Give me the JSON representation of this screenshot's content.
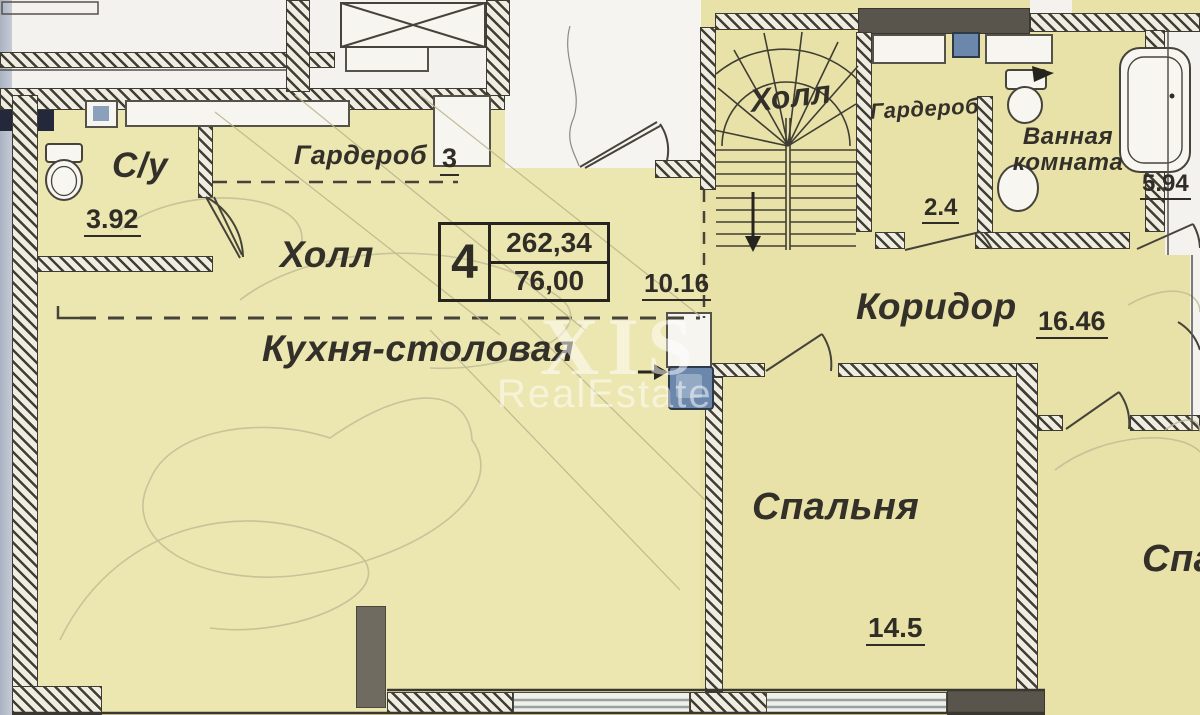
{
  "plan": {
    "unit_info": {
      "rooms_count": "4",
      "total_area": "262,34",
      "living_area": "76,00"
    },
    "rooms": {
      "su": {
        "name": "С/у",
        "area": "3.92"
      },
      "wardrobe_hall": {
        "name": "Гардероб",
        "area": "3"
      },
      "hall": {
        "name": "Холл",
        "area": "10.16"
      },
      "kitchen_dining": {
        "name": "Кухня-столовая"
      },
      "stair_hall": {
        "name": "Холл"
      },
      "wardrobe_2": {
        "name": "Гардероб",
        "area": "2.4"
      },
      "bathroom": {
        "name": "Ванная комната",
        "area": "5.94"
      },
      "corridor": {
        "name": "Коридор",
        "area": "16.46"
      },
      "bedroom_1": {
        "name": "Спальня",
        "area": "14.5"
      },
      "bedroom_2": {
        "name": "Спальня"
      }
    },
    "watermark": {
      "big": "XIS",
      "small": "RealEstate"
    },
    "colors": {
      "room_fill": "#ece6b0",
      "wall": "#3e3b33",
      "fixture_blue": "#6c87ac"
    }
  }
}
